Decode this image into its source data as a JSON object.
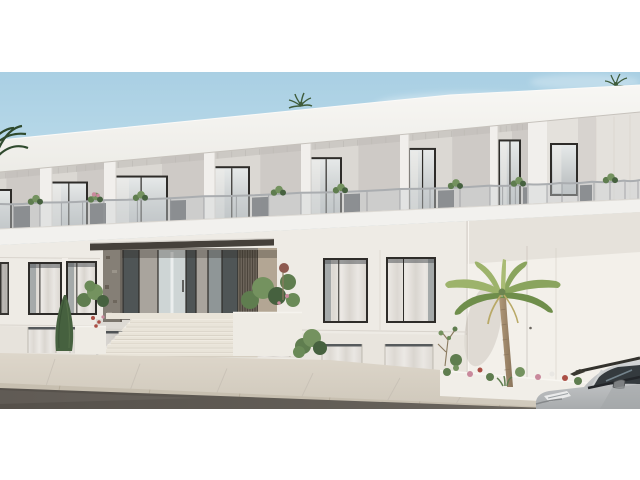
{
  "scene_description": "3D exterior render of a modern two-storey white apartment building with recessed glass balconies, a central entrance with wide stone stairs and dark canopy, palm trees, flower beds, a sidewalk with asphalt road and a silver car parked at the lower right. White letterbox bands at top and bottom.",
  "palette": {
    "white": "#ffffff",
    "sky_top": "#a9cfe3",
    "sky_mid": "#c6e2ee",
    "sky_low": "#e2eff5",
    "cloud": "#ffffff",
    "parapet_hi": "#f8f7f4",
    "parapet_lo": "#ecebe6",
    "parapet_edge": "#c6c2bc",
    "recess": "#dbd8d3",
    "recess_shade": "#c9c6c1",
    "recess_lite": "#e4e1dc",
    "ceiling": "#bdbab5",
    "column": "#f1efec",
    "column_shade": "#d6d3ce",
    "frame": "#2e2c29",
    "door_glass_hi": "#e6e9e9",
    "door_glass_lo": "#b4b9bb",
    "curtain": "#efedea",
    "rail_glass": "#cdd2d5",
    "rail_post": "#95989b",
    "rail_hand": "#aaadb0",
    "rail_dark": "#85898c",
    "slab": "#f2f1ee",
    "slab_shadow": "#b6b1aa",
    "slab_edge": "#dedbd6",
    "wall": "#eeebe5",
    "wall_low": "#e4dfd7",
    "wall_wing": "#f3f0ea",
    "wall_seam": "#d8d3cc",
    "win_top": "#565a5c",
    "win_glass": "#9aa0a1",
    "win_curtain_a": "#ebe8e4",
    "win_curtain_b": "#dcd8d2",
    "canopy": "#45403a",
    "canopy_top": "#d8d4ce",
    "canopy_shadow": "#2e2a26",
    "stone": "#857f76",
    "stone_dark": "#675f55",
    "ent_glass_dark": "#4f5556",
    "ent_glass_bright": "#ced5d5",
    "ent_glass_med": "#8f9697",
    "ent_wall": "#a9a49d",
    "louver_a": "#6e665b",
    "louver_b": "#4c453c",
    "tan_wall": "#b3a694",
    "planter": "#eeebe4",
    "stair_tread": "#e9e4d9",
    "stair_riser": "#cfc8bb",
    "sidewalk_a": "#ded7cb",
    "sidewalk_b": "#cfc8bb",
    "seam": "#c1bab0",
    "curb": "#c7bfb0",
    "asphalt_a": "#6b665f",
    "asphalt_b": "#55504a",
    "foliage": "#5f7d4f",
    "foliage_dark": "#46613f",
    "foliage_lite": "#74925f",
    "twig": "#8a7a5f",
    "far_palm": "#3f5c3b",
    "edge_palm": "#2f4a2e",
    "flower_red": "#ab4f45",
    "flower_pink": "#c9899c",
    "flower_white": "#e9e7e3",
    "palm_frond_a": "#8aa45e",
    "palm_frond_b": "#6f8e4b",
    "palm_frond_c": "#9db36b",
    "palm_frond_d": "#a9bb74",
    "palm_dead": "#b9a967",
    "trunk_a": "#b09878",
    "trunk_b": "#8a745b",
    "car_body_hi": "#d8dadb",
    "car_body_lo": "#a8abad",
    "car_glass": "#343a3e",
    "car_trim": "#33322d",
    "car_light": "#eaebeb"
  },
  "geometry": {
    "bands": {
      "scene_top": 72,
      "scene_bottom": 409
    },
    "lines": {
      "roof": [
        [
          0,
          140
        ],
        [
          450,
          95
        ],
        [
          640,
          85
        ]
      ],
      "parapet_bottom": [
        [
          0,
          172
        ],
        [
          450,
          130
        ],
        [
          640,
          112
        ]
      ],
      "rail_top": [
        [
          0,
          204
        ],
        [
          640,
          180
        ]
      ],
      "slab_top": [
        [
          0,
          229
        ],
        [
          640,
          199
        ]
      ],
      "slab_bottom": [
        [
          0,
          245
        ],
        [
          640,
          212
        ]
      ],
      "walk_top": [
        [
          0,
          353
        ],
        [
          640,
          388
        ]
      ]
    },
    "bays": {
      "cols": [
        -40,
        40,
        104,
        204,
        301,
        400,
        490
      ],
      "door_widths": [
        44,
        40,
        56,
        38,
        33,
        28,
        23
      ],
      "col_widths": [
        0,
        12,
        12,
        11,
        10,
        9,
        8
      ],
      "corner_pillar": [
        528,
        547
      ],
      "wing_door": [
        550,
        578,
        143,
        196
      ],
      "wing_seams": [
        596,
        614,
        630
      ]
    },
    "balcony_plants": [
      {
        "x": 35
      },
      {
        "x": 95,
        "pink": true
      },
      {
        "x": 140
      },
      {
        "x": 278
      },
      {
        "x": 340
      },
      {
        "x": 455
      },
      {
        "x": 518
      },
      {
        "x": 610
      }
    ],
    "stairs": {
      "steps": 9,
      "top_y": 319,
      "rise": 4.2,
      "x_left": 130,
      "dl": 3.8,
      "x_right": 240,
      "dr": 2.2
    },
    "ground_windows": [
      {
        "x": 28,
        "w": 34,
        "y": 262,
        "h": 53,
        "dark_side": "l"
      },
      {
        "x": 66,
        "w": 31,
        "y": 261,
        "h": 54,
        "dark_side": "l"
      },
      {
        "x": 323,
        "w": 45,
        "y": 258,
        "h": 65,
        "dark_side": "l"
      },
      {
        "x": 386,
        "w": 50,
        "y": 257,
        "h": 66,
        "dark_side": "r"
      }
    ],
    "basement_windows": [
      {
        "x": 28,
        "w": 28,
        "y": 327,
        "h": 26
      },
      {
        "x": 70,
        "w": 26,
        "y": 327,
        "h": 26
      },
      {
        "x": 104,
        "w": 64,
        "y": 331,
        "h": 24
      },
      {
        "x": 248,
        "w": 42,
        "y": 333,
        "h": 24
      },
      {
        "x": 322,
        "w": 40,
        "y": 344,
        "h": 26
      },
      {
        "x": 385,
        "w": 48,
        "y": 344,
        "h": 26
      }
    ],
    "entrance_panels": [
      {
        "x0": 123,
        "x1": 139,
        "t": "glass_dark"
      },
      {
        "x0": 139,
        "x1": 158,
        "t": "wall"
      },
      {
        "x0": 158,
        "x1": 186,
        "t": "glass_bright"
      },
      {
        "x0": 186,
        "x1": 196,
        "t": "glass_dark"
      },
      {
        "x0": 196,
        "x1": 208,
        "t": "wall"
      },
      {
        "x0": 208,
        "x1": 222,
        "t": "glass_med"
      },
      {
        "x0": 222,
        "x1": 238,
        "t": "glass_dark"
      }
    ],
    "sidewalk_seams": [
      55,
      140,
      227,
      313,
      400,
      470
    ],
    "curb_ticks": [
      60,
      150,
      240,
      330,
      420,
      500
    ],
    "flower_bed": [
      {
        "x": 447,
        "y": 372,
        "r": 4,
        "c": "foliage"
      },
      {
        "x": 456,
        "y": 368,
        "r": 3,
        "c": "foliage_lite"
      },
      {
        "x": 470,
        "y": 374,
        "r": 3,
        "c": "flower_pink"
      },
      {
        "x": 480,
        "y": 370,
        "r": 2.5,
        "c": "flower_red"
      },
      {
        "x": 490,
        "y": 377,
        "r": 4,
        "c": "foliage"
      },
      {
        "x": 520,
        "y": 372,
        "r": 5,
        "c": "foliage_lite"
      },
      {
        "x": 538,
        "y": 377,
        "r": 3,
        "c": "flower_pink"
      },
      {
        "x": 552,
        "y": 374,
        "r": 2.5,
        "c": "flower_white"
      },
      {
        "x": 565,
        "y": 378,
        "r": 3,
        "c": "flower_red"
      },
      {
        "x": 578,
        "y": 381,
        "r": 4,
        "c": "foliage"
      },
      {
        "x": 595,
        "y": 380,
        "r": 2.5,
        "c": "flower_pink"
      },
      {
        "x": 608,
        "y": 384,
        "r": 4,
        "c": "foliage_dark"
      },
      {
        "x": 622,
        "y": 384,
        "r": 2.5,
        "c": "flower_red"
      },
      {
        "x": 633,
        "y": 387,
        "r": 3,
        "c": "foliage"
      }
    ]
  }
}
